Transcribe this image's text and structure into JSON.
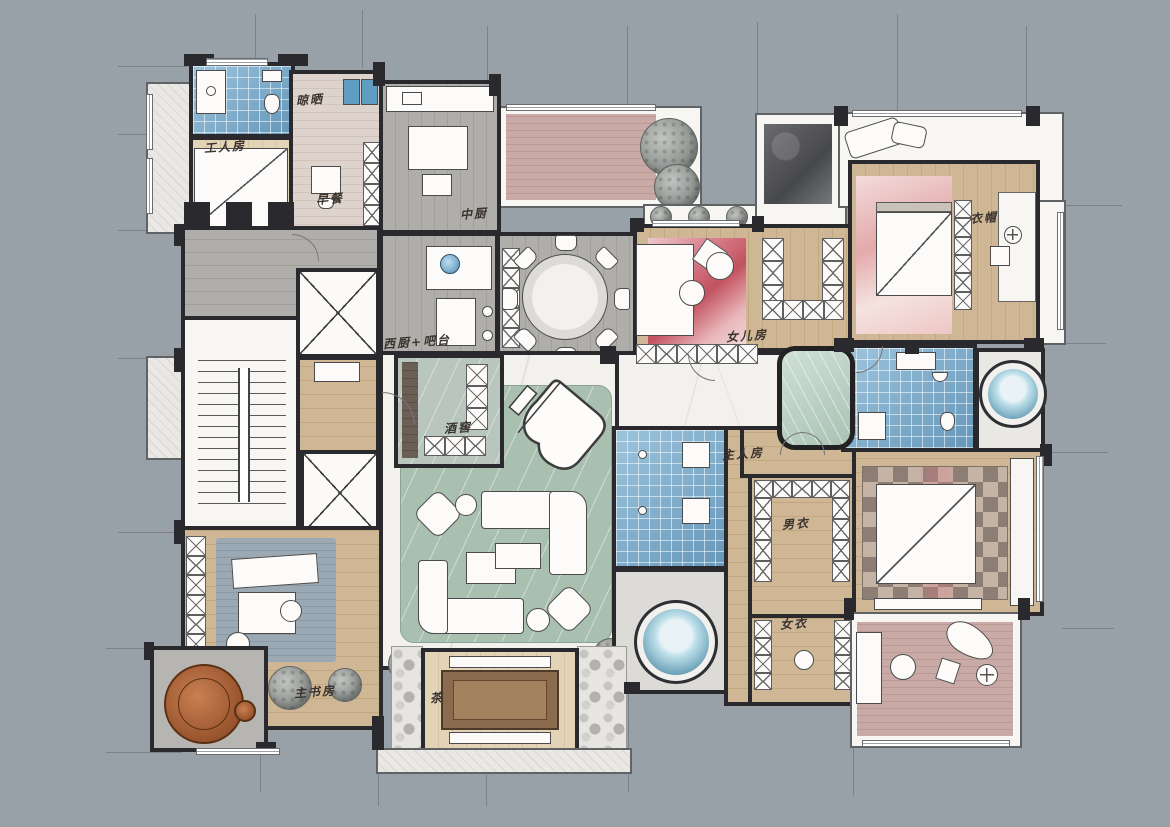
{
  "plan": {
    "type": "hand-rendered residential floor plan",
    "rooms": [
      {
        "id": "laundry",
        "label": "晾晒"
      },
      {
        "id": "maid-room",
        "label": "工人房"
      },
      {
        "id": "breakfast",
        "label": "早餐"
      },
      {
        "id": "chinese-kitchen",
        "label": "中厨"
      },
      {
        "id": "western-kitchen-bar",
        "label": "西厨+吧台"
      },
      {
        "id": "wine-cellar",
        "label": "酒窖"
      },
      {
        "id": "daughter-room",
        "label": "女儿房"
      },
      {
        "id": "cloakroom",
        "label": "衣帽"
      },
      {
        "id": "master-room",
        "label": "主人房"
      },
      {
        "id": "his-closet",
        "label": "男衣"
      },
      {
        "id": "her-closet",
        "label": "女衣"
      },
      {
        "id": "master-study",
        "label": "主书房"
      },
      {
        "id": "tea-room",
        "label": "茶"
      }
    ],
    "colors": {
      "background": "#99a1a8",
      "wall": "#2a292d",
      "wood": "#cfb795",
      "wood_light": "#e3d4b8",
      "marble": "#f2f1ed",
      "tile_blue": "#7cb0d1",
      "rug_green": "#a9bfb0",
      "rug_red": "#c2525f",
      "deck_pink": "#c9aaa6",
      "glass_green": "#a9c2b4",
      "leather": "#a05a32"
    }
  }
}
